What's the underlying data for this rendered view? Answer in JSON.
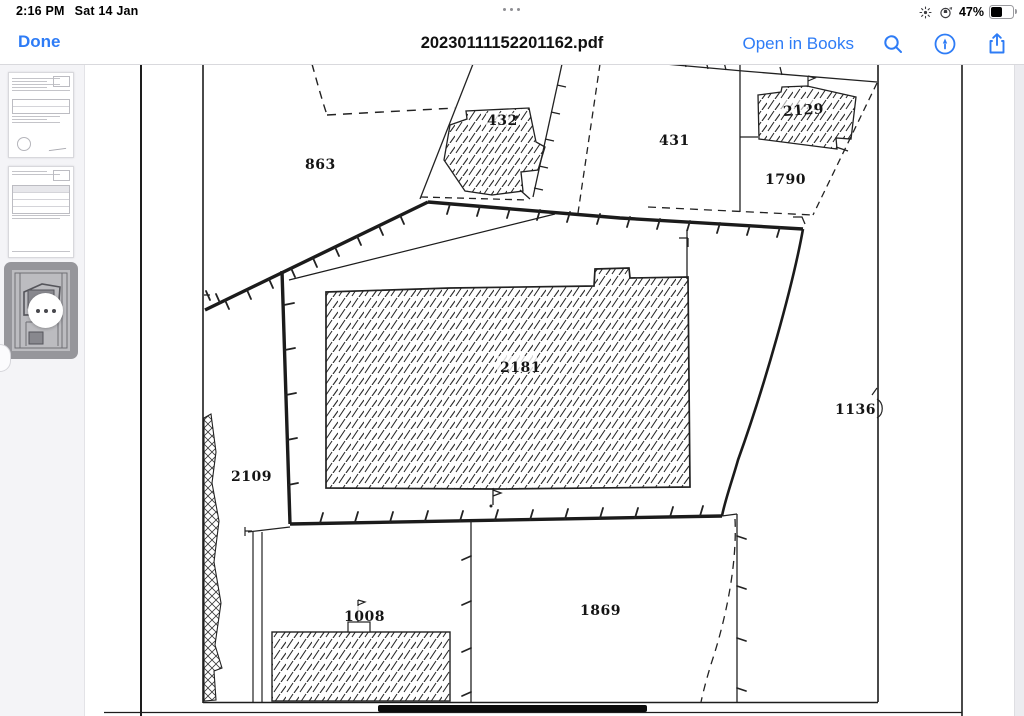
{
  "colors": {
    "accent": "#2E7CF6",
    "selection_gray": "#96969B",
    "map_ink": "#1d1d1d"
  },
  "status_bar": {
    "time": "2:16 PM",
    "date": "Sat 14 Jan",
    "battery_percent": "47%",
    "icons": [
      "brightness-icon",
      "orientation-lock-icon",
      "battery-icon"
    ]
  },
  "toolbar": {
    "done_label": "Done",
    "title": "20230111152201162.pdf",
    "open_in_books_label": "Open in Books",
    "icons": [
      "search-icon",
      "markup-icon",
      "share-icon"
    ]
  },
  "sidebar": {
    "page_count": 3,
    "selected_page_index": 3,
    "selected_page_has_more_button": true
  },
  "map": {
    "type": "cadastral-plan-page",
    "labels": [
      {
        "id": "863",
        "text": "863"
      },
      {
        "id": "432",
        "text": "432"
      },
      {
        "id": "431",
        "text": "431"
      },
      {
        "id": "2129",
        "text": "2129"
      },
      {
        "id": "1790",
        "text": "1790"
      },
      {
        "id": "2181",
        "text": "2181"
      },
      {
        "id": "1136",
        "text": "1136"
      },
      {
        "id": "2109",
        "text": "2109"
      },
      {
        "id": "1008",
        "text": "1008"
      },
      {
        "id": "1869",
        "text": "1869"
      }
    ]
  }
}
